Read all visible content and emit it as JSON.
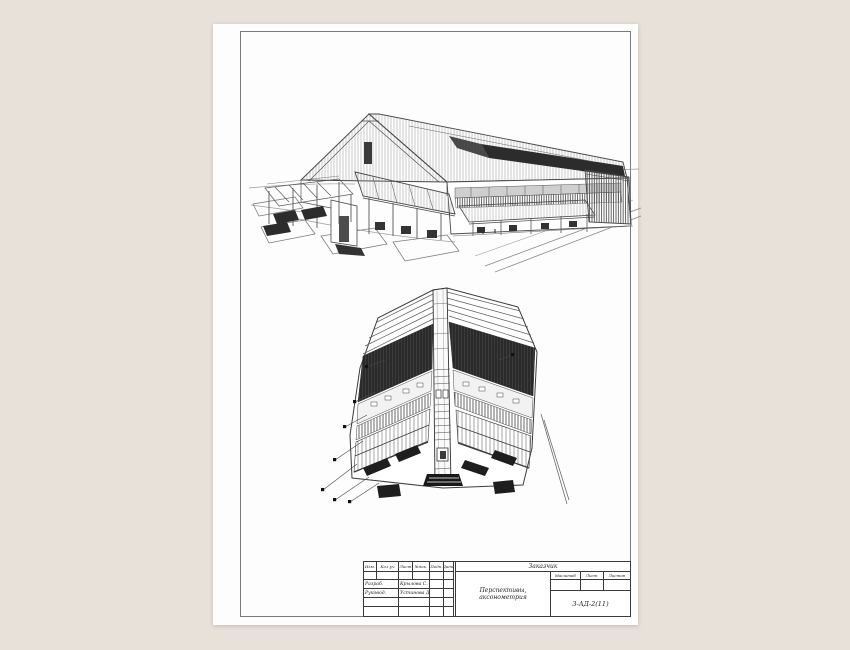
{
  "colors": {
    "background": "#e8e1da",
    "paper": "#fdfdfd",
    "frame_line": "#7a7a7a",
    "ink": "#3c3c3c",
    "dark_hatch": "#2c2c2c"
  },
  "title_block": {
    "top_cell": "Заказчик",
    "sheet_title": "Перспективы, аксонометрия",
    "revision_header": [
      "Изм.",
      "Кол.уч",
      "Лист",
      "№док.",
      "Подп.",
      "Дата"
    ],
    "signature_rows": [
      {
        "role": "Разраб.",
        "name": "Крылова С."
      },
      {
        "role": "Руковод.",
        "name": "Устинова Д."
      }
    ],
    "meta_headers": [
      "Масштаб",
      "Лист",
      "Листов"
    ],
    "group_code": "3-АД-2(11)"
  }
}
